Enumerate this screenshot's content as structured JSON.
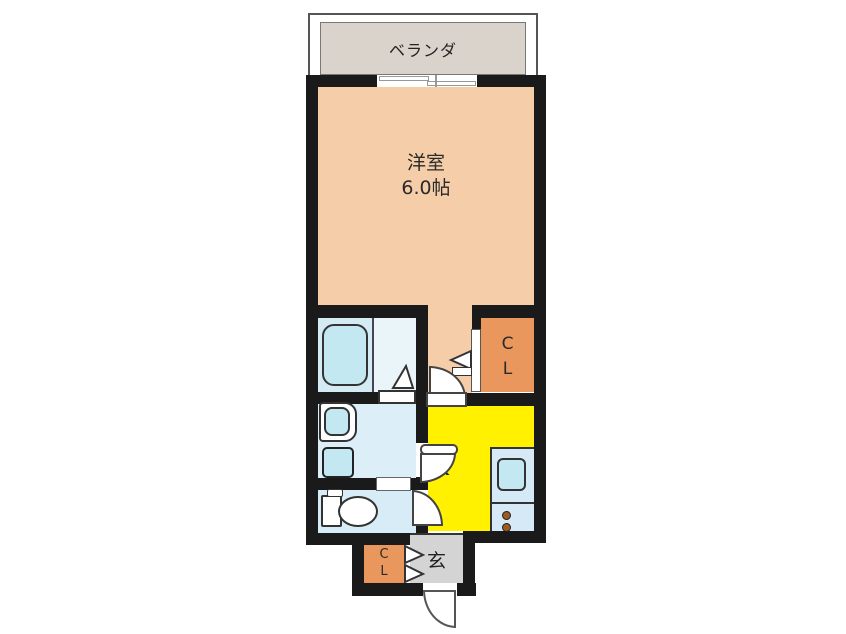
{
  "floorplan": {
    "balcony": {
      "label": "ベランダ"
    },
    "western_room": {
      "label": "洋室",
      "size": "6.0帖"
    },
    "closet_upper": {
      "line1": "C",
      "line2": "L"
    },
    "kitchen": {
      "label": "K"
    },
    "entrance": {
      "label": "玄"
    },
    "closet_lower": {
      "line1": "C",
      "line2": "L"
    },
    "colors": {
      "wall": "#1a1a1a",
      "room_salmon": "#f5cda9",
      "closet_orange": "#e9975c",
      "kitchen_yellow": "#fff100",
      "bath_blue": "#d5ebf4",
      "bath_blue_light": "#eaf5fa",
      "washroom_blue": "#dceef8",
      "toilet_blue": "#d8ecf7",
      "counter_blue": "#d5eaf6",
      "fixture_blue": "#c4e8f2",
      "entrance_gray": "#d4d4d4",
      "balcony_gray": "#d9d3cb",
      "burner_brown": "#9c5b21"
    }
  }
}
